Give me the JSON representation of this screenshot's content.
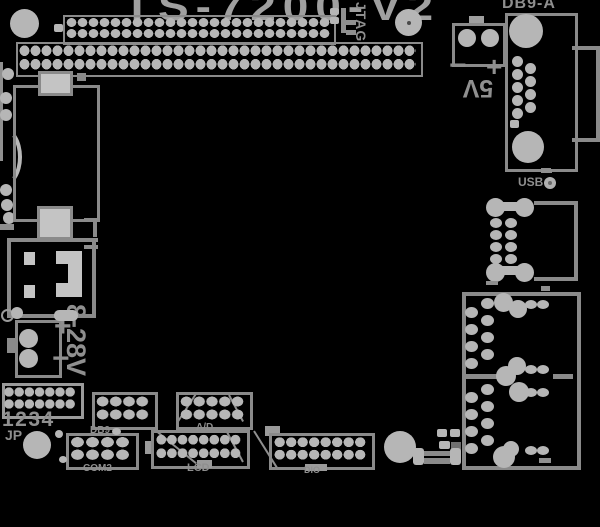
{
  "diagram": {
    "title": "TS-7200-V2",
    "labels": {
      "db9_connector": "DB9-A",
      "jtag": "JTAG",
      "v5": "5V",
      "v5_plus": "+",
      "v5_minus": "−",
      "usb": "USB",
      "power": "8-28V",
      "power_plus": "+",
      "power_minus": "−",
      "jumper_numbers": "1234",
      "jumper_prefix": "JP",
      "com2": "COM2",
      "db9_header": "DB9",
      "ad": "A/D",
      "lcd": "LCD",
      "dio": "DIO"
    },
    "colors": {
      "background": "#000000",
      "pad": "#b6b6b6",
      "outline": "#8a8a8a",
      "text": "#979797"
    }
  }
}
